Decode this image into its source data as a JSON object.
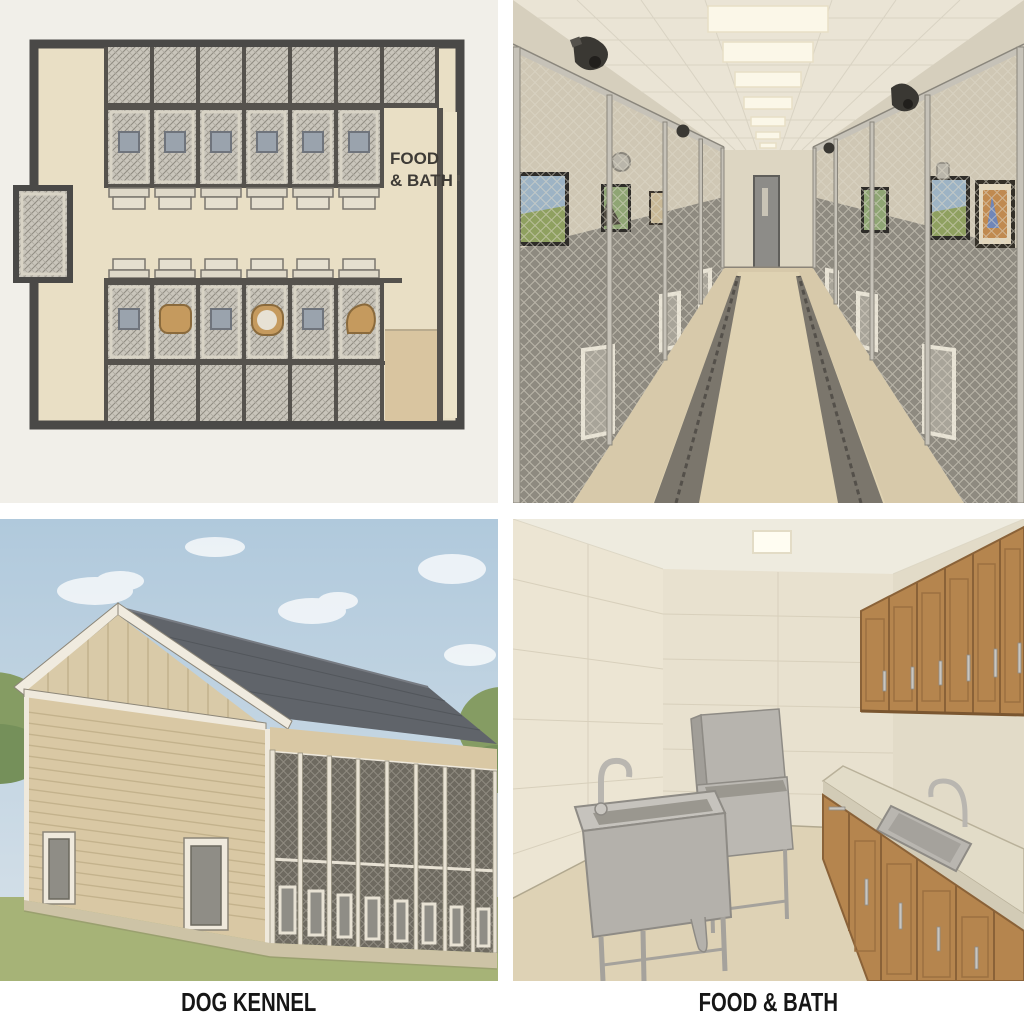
{
  "title": "Dog kennel facility illustration",
  "panels": {
    "floor_plan": {
      "name": "Kennel floor plan",
      "room_label_line1": "FOOD",
      "room_label_line2": "& BATH"
    },
    "corridor": {
      "name": "Indoor kennel corridor with chain-link runs"
    },
    "exterior": {
      "name": "Dog kennel building exterior"
    },
    "wash_room": {
      "name": "Food and bath prep room"
    }
  },
  "captions": {
    "left": "DOG KENNEL",
    "right": "FOOD & BATH"
  },
  "colors": {
    "paper": "#f1efe9",
    "plan_floor": "#e9dfc5",
    "plan_wall": "#4a4947",
    "plan_hatch": "#c9c5bb",
    "plan_window": "#9aa3ad",
    "dog_bed": "#c59a5e",
    "corridor_wall": "#cfc7b4",
    "corridor_floor": "#d7c9aa",
    "kennel_panel_gray": "#8e8a80",
    "sky": "#b7cede",
    "grass": "#a6b377",
    "roof": "#5f6366",
    "siding": "#d9c8a4",
    "screen_mesh": "#6e6a60",
    "cabinet_wood": "#b5854e",
    "stainless_steel": "#b9b6b0",
    "caption_text": "#161616"
  }
}
